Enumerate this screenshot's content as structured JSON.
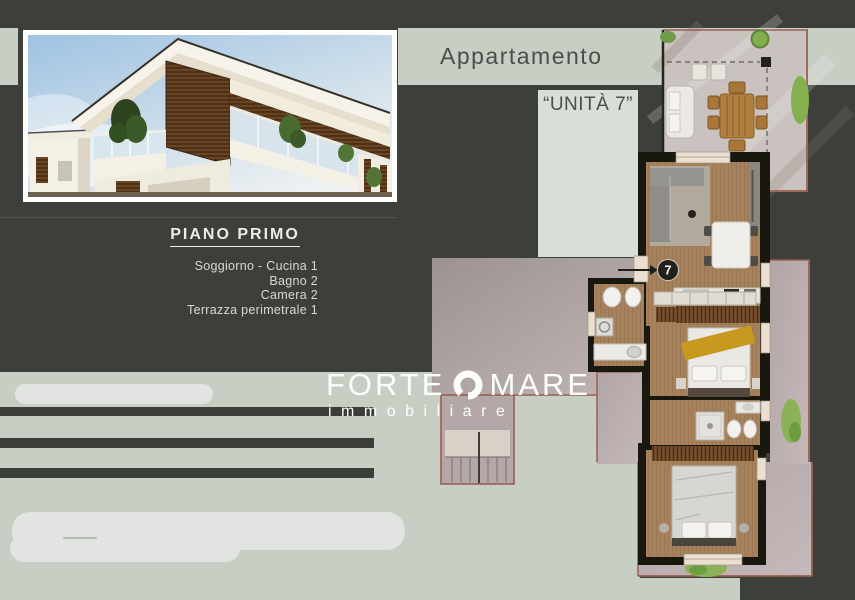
{
  "header": {
    "title": "Appartamento",
    "unit": "“UNITÀ 7”"
  },
  "plan_info": {
    "title": "PIANO PRIMO",
    "items": [
      "Soggiorno - Cucina 1",
      "Bagno 2",
      "Camera 2",
      "Terrazza perimetrale 1"
    ]
  },
  "logo": {
    "word_left": "FORTE",
    "word_right": "MARE",
    "subtitle": "immobiliare",
    "ring_icon": "ring-icon"
  },
  "floorplan": {
    "unit_marker": "7"
  },
  "colors": {
    "background_charcoal": "#3c3f3a",
    "sage_band": "#c7cec4",
    "unita_panel": "#d9dfd7",
    "terrace_paving": "#cac2be",
    "terrace_border": "#9a5e51",
    "courtyard_mauve": "#b0a5a5",
    "wood_floor": "#a6825c",
    "wall_black": "#19180f",
    "bed_throw_yellow": "#c8991f",
    "plant_green": "#8bb257",
    "text_light": "#ebebe7",
    "text_dark": "#4b4f49"
  }
}
